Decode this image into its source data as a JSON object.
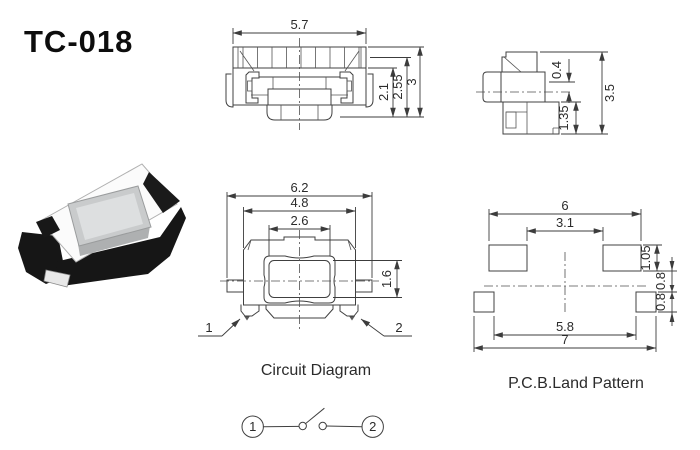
{
  "title": "TC-018",
  "colors": {
    "background": "#ffffff",
    "line": "#404040",
    "text": "#2b2b2b",
    "photo_body": "#fbfbfb",
    "photo_button": "#d2d4d5",
    "photo_clip": "#161616"
  },
  "front_view": {
    "dim_width": "5.7",
    "dim_height_inner": "2.1",
    "dim_height_mid": "2.55",
    "dim_height_total": "3"
  },
  "side_view": {
    "dim_top_offset": "0.4",
    "dim_base_height": "1.35",
    "dim_total_height": "3.5"
  },
  "plan_view": {
    "dim_total_width": "6.2",
    "dim_body_width": "4.8",
    "dim_button_width": "2.6",
    "dim_button_height": "1.6",
    "pin1_label": "1",
    "pin2_label": "2"
  },
  "pcb_pattern": {
    "label": "P.C.B.Land Pattern",
    "dim_pad_span": "6",
    "dim_pad_gap": "3.1",
    "dim_pad_height": "1.05",
    "dim_offset_upper": "0.8",
    "dim_offset_lower": "0.8",
    "dim_bottom_span": "5.8",
    "dim_total_width": "7"
  },
  "circuit": {
    "label": "Circuit Diagram",
    "terminal1": "1",
    "terminal2": "2"
  }
}
